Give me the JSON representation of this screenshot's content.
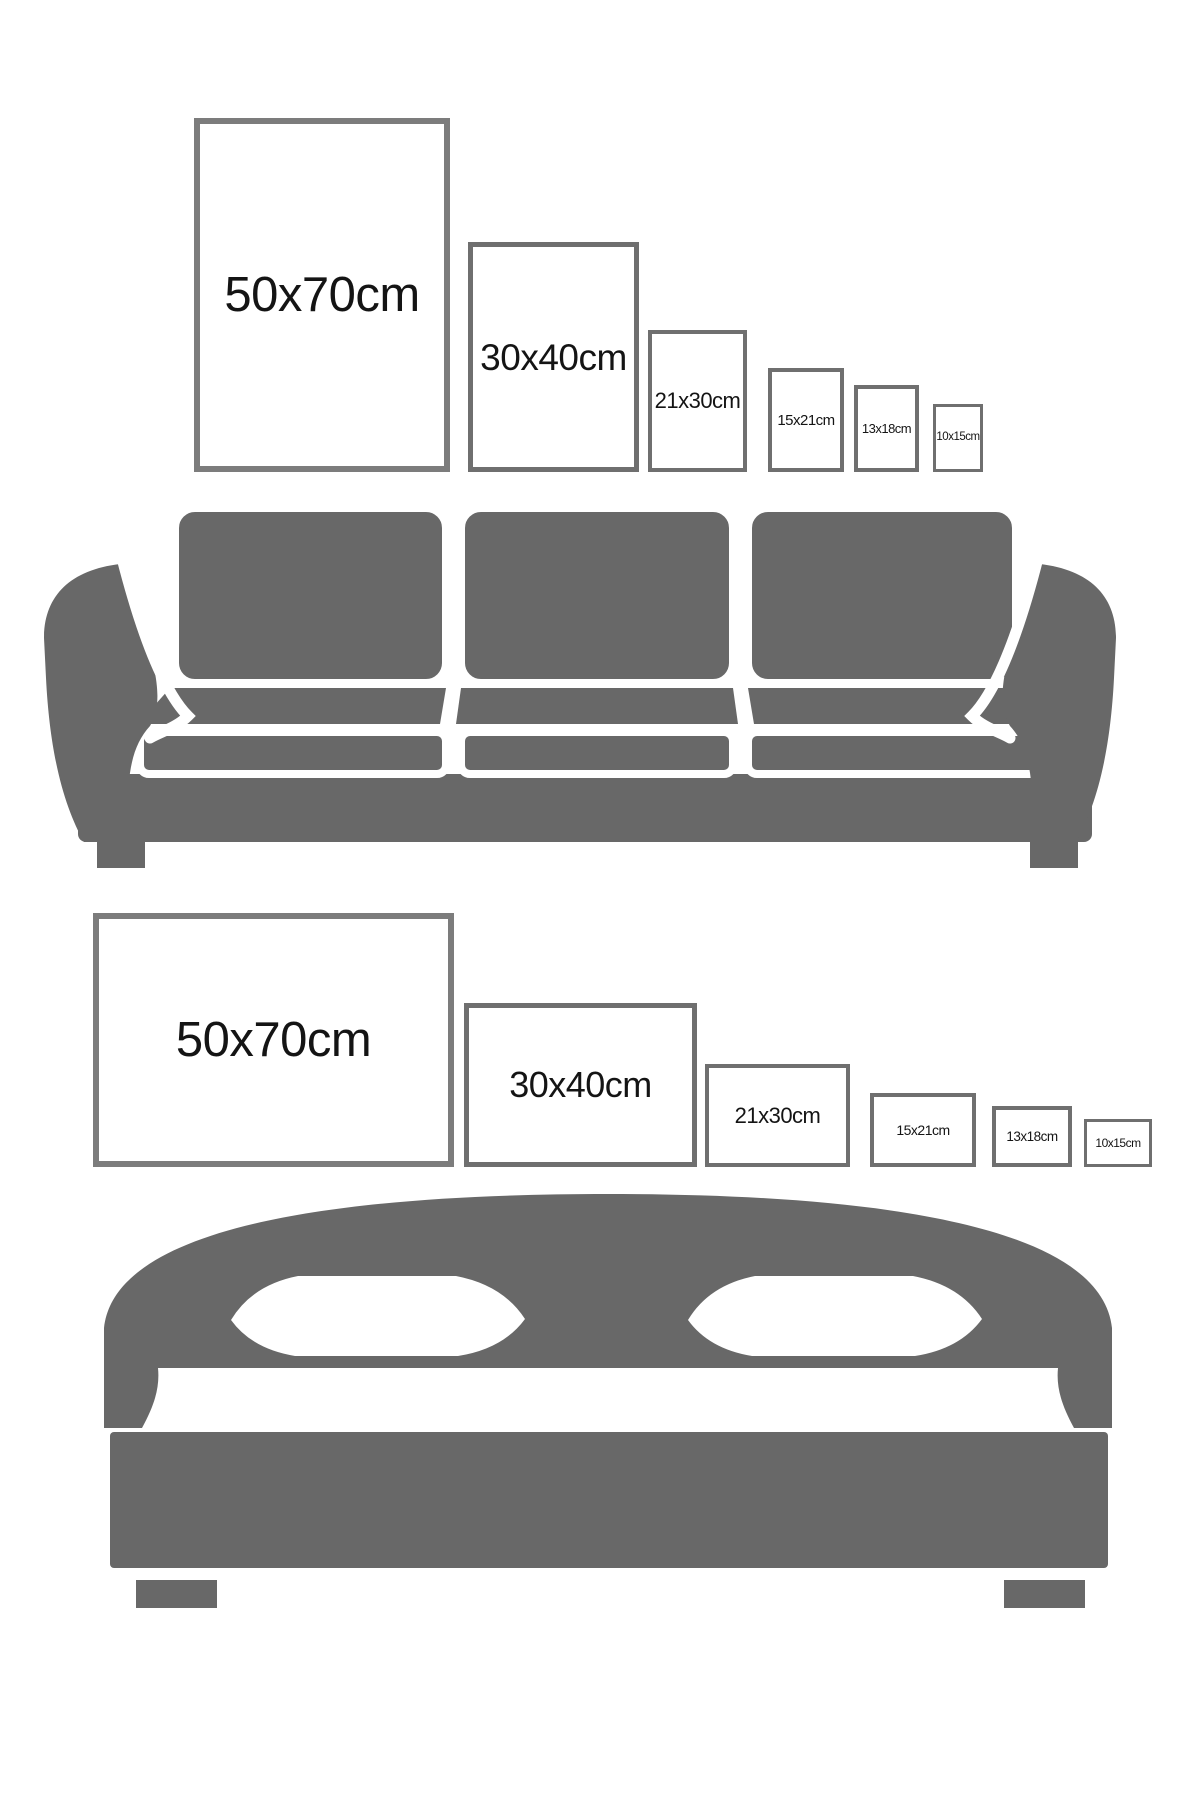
{
  "colors": {
    "background": "#ffffff",
    "furniture": "#686868",
    "frame_border_large": "#7c7c7c",
    "frame_border_small": "#6f6f6f",
    "label": "#141414",
    "white": "#ffffff"
  },
  "top_section": {
    "furniture": "sofa",
    "frame_orientation": "portrait",
    "frames": [
      {
        "label": "50x70cm"
      },
      {
        "label": "30x40cm"
      },
      {
        "label": "21x30cm"
      },
      {
        "label": "15x21cm"
      },
      {
        "label": "13x18cm"
      },
      {
        "label": "10x15cm"
      }
    ]
  },
  "bottom_section": {
    "furniture": "bed",
    "frame_orientation": "landscape",
    "frames": [
      {
        "label": "50x70cm"
      },
      {
        "label": "30x40cm"
      },
      {
        "label": "21x30cm"
      },
      {
        "label": "15x21cm"
      },
      {
        "label": "13x18cm"
      },
      {
        "label": "10x15cm"
      }
    ]
  }
}
